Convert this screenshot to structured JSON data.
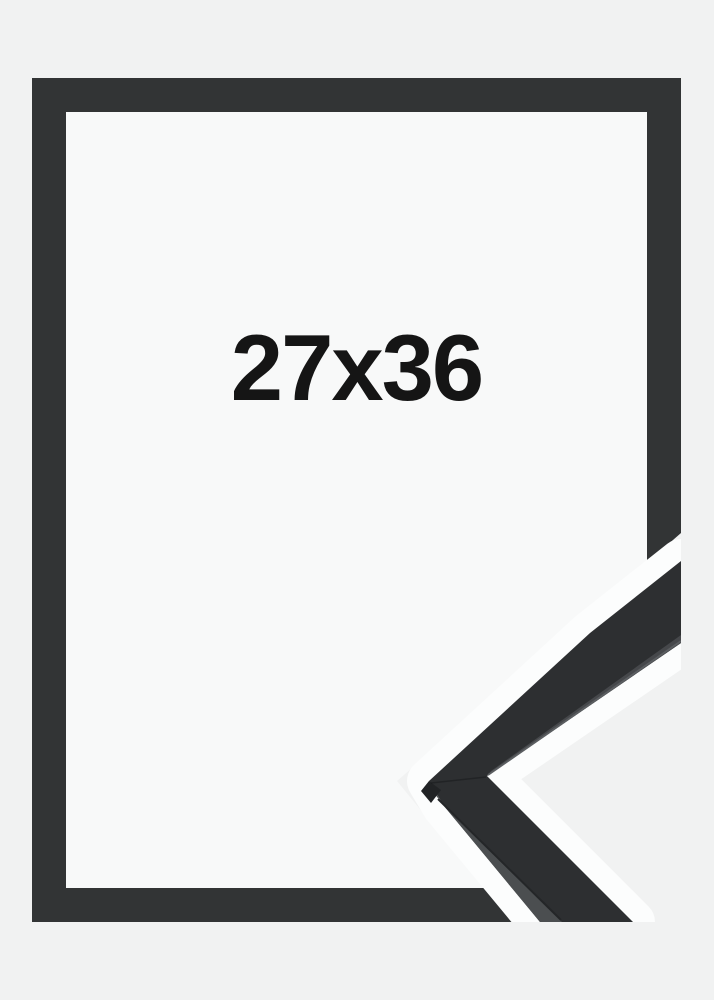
{
  "product_image": {
    "size_label": "27x36",
    "colors": {
      "page_background": "#f1f2f2",
      "frame_front": "#323435",
      "frame_opening": "#f8f9f9",
      "sample_halo": "#fcfdfd",
      "sample_moulding": "#2d2f31",
      "sample_side_face": "#4b4e50",
      "sample_chamfer": "#212325",
      "label_text": "#151515"
    }
  }
}
